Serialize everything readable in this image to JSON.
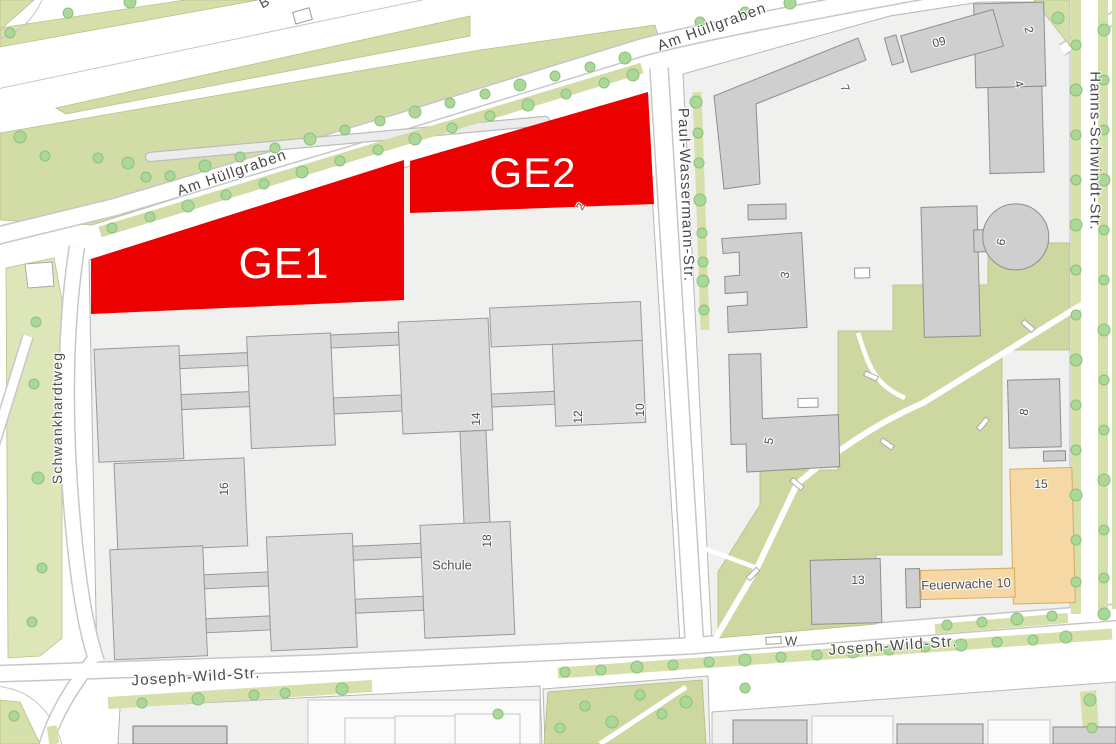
{
  "map": {
    "description": "City map extract (Munich) with two red commercial planning zones on a school block",
    "colors": {
      "zone_red": "#ec0000",
      "green_area": "#d2dca6",
      "park_green": "#cdd8a0",
      "tree_green": "#abd798",
      "building_grey": "#d9d9d9",
      "building_orange": "#f6d8a4",
      "block_background": "#f0f0ee"
    },
    "zones": [
      {
        "id": "GE1",
        "label": "GE1"
      },
      {
        "id": "GE2",
        "label": "GE2"
      }
    ],
    "streets": {
      "am_huellgraben_nw": "Am Hüllgraben",
      "am_huellgraben_ne": "Am Hüllgraben",
      "paul_wassermann": "Paul-Wassermann-Str.",
      "hanns_schwindt": "Hanns-Schwindt-Str.",
      "schwankhardtweg": "Schwankhardtweg",
      "joseph_wild_west": "Joseph-Wild-Str.",
      "joseph_wild_east": "Joseph-Wild-Str.",
      "w_partial": "W",
      "b_partial": "B"
    },
    "buildings": {
      "schule": "Schule",
      "feuerwache": "Feuerwache 10",
      "n14": "14",
      "n12": "12",
      "n10": "10",
      "n16": "16",
      "n18": "18",
      "n7": "7",
      "n09": "09",
      "n2_ne": "2",
      "n4": "4",
      "n3": "3",
      "n5": "5",
      "n6": "6",
      "n8": "8",
      "n15": "15",
      "n13": "13",
      "n2_ge2": "2"
    }
  }
}
